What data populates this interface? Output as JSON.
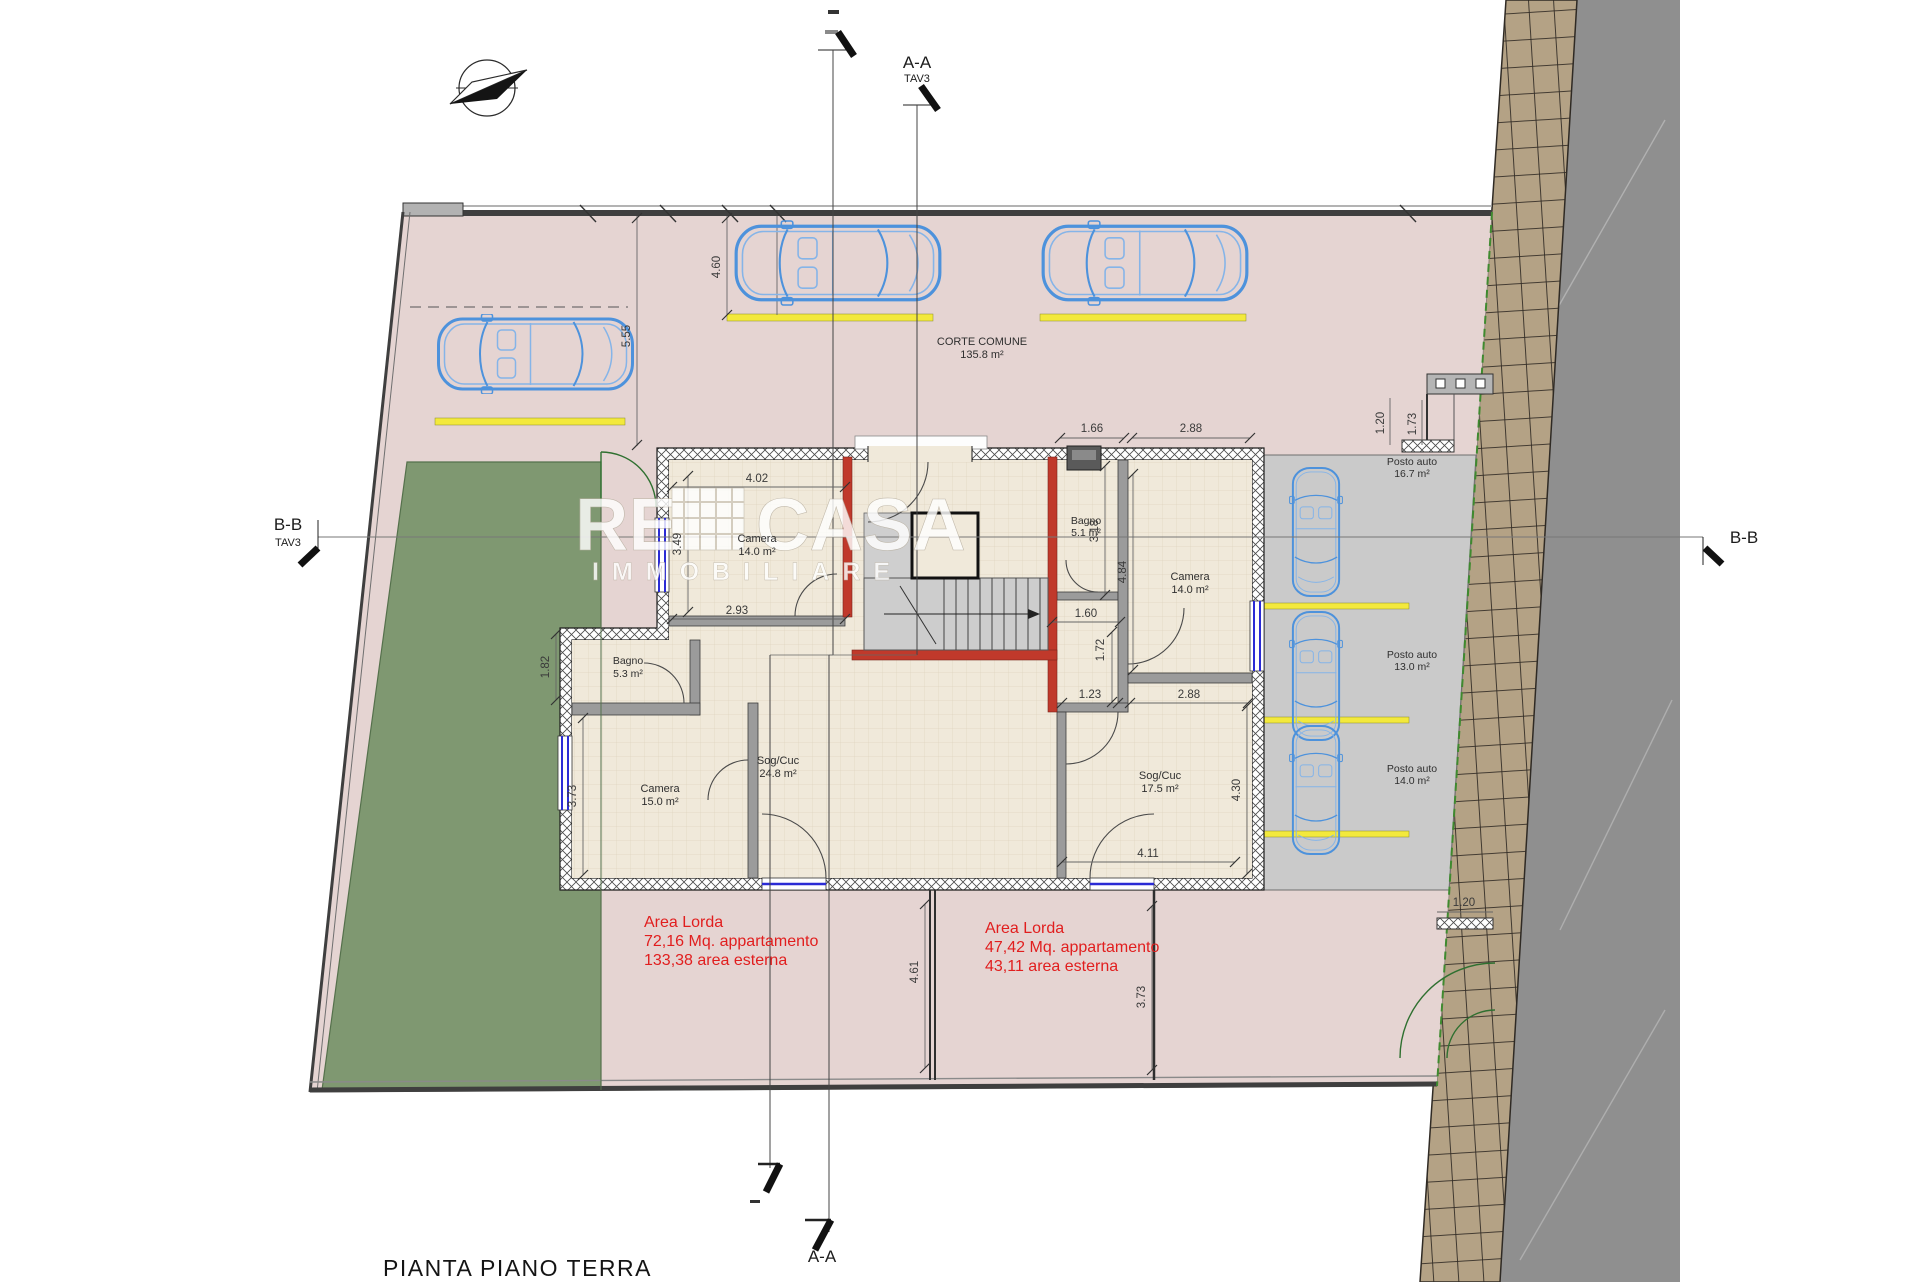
{
  "title": "PIANTA PIANO TERRA",
  "sections": {
    "top_label": "A-A",
    "top_sub": "TAV3",
    "bottom_label": "A-A",
    "left_label": "B-B",
    "left_sub": "TAV3",
    "right_label": "B-B"
  },
  "watermark": {
    "part1": "RE",
    "part2": "CASA",
    "part3": "IMMOBILIARE"
  },
  "rooms": [
    {
      "name": "CORTE COMUNE",
      "area": "135.8 m²"
    },
    {
      "name": "Camera",
      "area": "14.0 m²"
    },
    {
      "name": "Bagno",
      "area": "5.3 m²"
    },
    {
      "name": "Camera",
      "area": "15.0 m²"
    },
    {
      "name": "Sog/Cuc",
      "area": "24.8 m²"
    },
    {
      "name": "Bagno",
      "area": "5.1 m²"
    },
    {
      "name": "Camera",
      "area": "14.0 m²"
    },
    {
      "name": "Sog/Cuc",
      "area": "17.5 m²"
    },
    {
      "name": "Posto auto",
      "area": "16.7 m²"
    },
    {
      "name": "Posto auto",
      "area": "13.0 m²"
    },
    {
      "name": "Posto auto",
      "area": "14.0 m²"
    }
  ],
  "annotations": {
    "left": [
      "Area Lorda",
      "72,16 Mq. appartamento",
      "133,38 area esterna"
    ],
    "right": [
      "Area Lorda",
      "47,42 Mq. appartamento",
      "43,11 area esterna"
    ]
  },
  "dimensions": {
    "stall_depth": "4.60",
    "court_left": "5.55",
    "cam14l_w": "4.02",
    "cam14l_h": "3.49",
    "cam14l_b": "2.93",
    "bagno53_w": "1.82",
    "cam15_h": "3.73",
    "bagno51_w": "1.66",
    "cam14r_w_top": "2.88",
    "bagno51_h": "3.18",
    "cam14r_h": "4.84",
    "hall_w": "1.60",
    "hall_h": "1.72",
    "hall_b": "1.23",
    "sogr_w_top": "2.88",
    "sogr_h": "4.30",
    "sogr_b": "4.11",
    "terr_left": "4.61",
    "terr_right": "3.73",
    "tr_a": "1.20",
    "tr_b": "1.73",
    "br_a": "1.20"
  },
  "colors": {
    "courtyard": "#e5d4d2",
    "floor": "#f0e9da",
    "garden": "#7f9871",
    "parking": "#cacaca",
    "road": "#8f8f8f",
    "sidewalk": "#b4a285",
    "car_outline": "#4d92dc",
    "window": "#2b2bd5",
    "wall_accent": "#c0392b",
    "stall_line": "#f3e93c",
    "annotation_red": "#e11e1e"
  }
}
